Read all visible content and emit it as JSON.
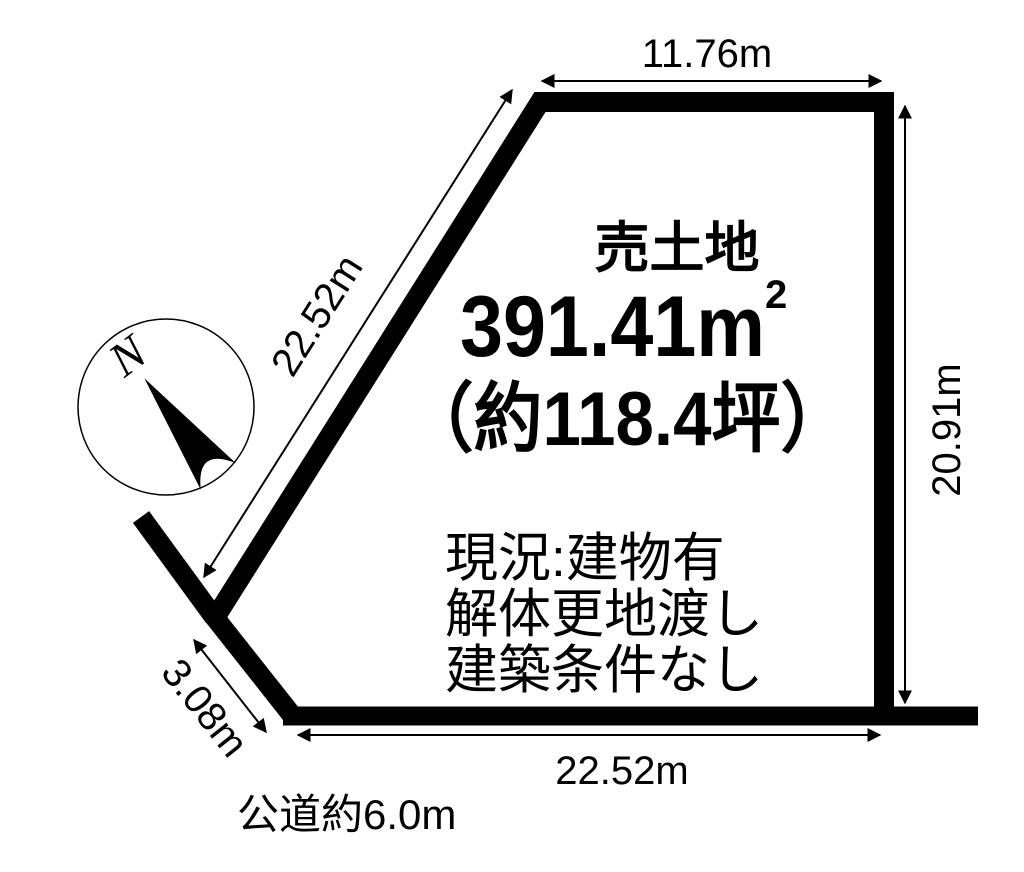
{
  "diagram": {
    "type_label": "売土地",
    "area_sqm": "391.41m",
    "area_sqm_sup": "2",
    "area_tsubo": "（約118.4坪）",
    "status_lines": [
      "現況:建物有",
      "解体更地渡し",
      "建築条件なし"
    ],
    "road_label": "公道約6.0m",
    "compass": {
      "north_label": "N"
    },
    "dimensions": {
      "top_edge": "11.76m",
      "right_edge": "20.91m",
      "left_diagonal_edge": "22.52m",
      "bottom_edge": "22.52m",
      "short_edge": "3.08m"
    },
    "colors": {
      "line": "#000000",
      "background": "#ffffff"
    }
  }
}
